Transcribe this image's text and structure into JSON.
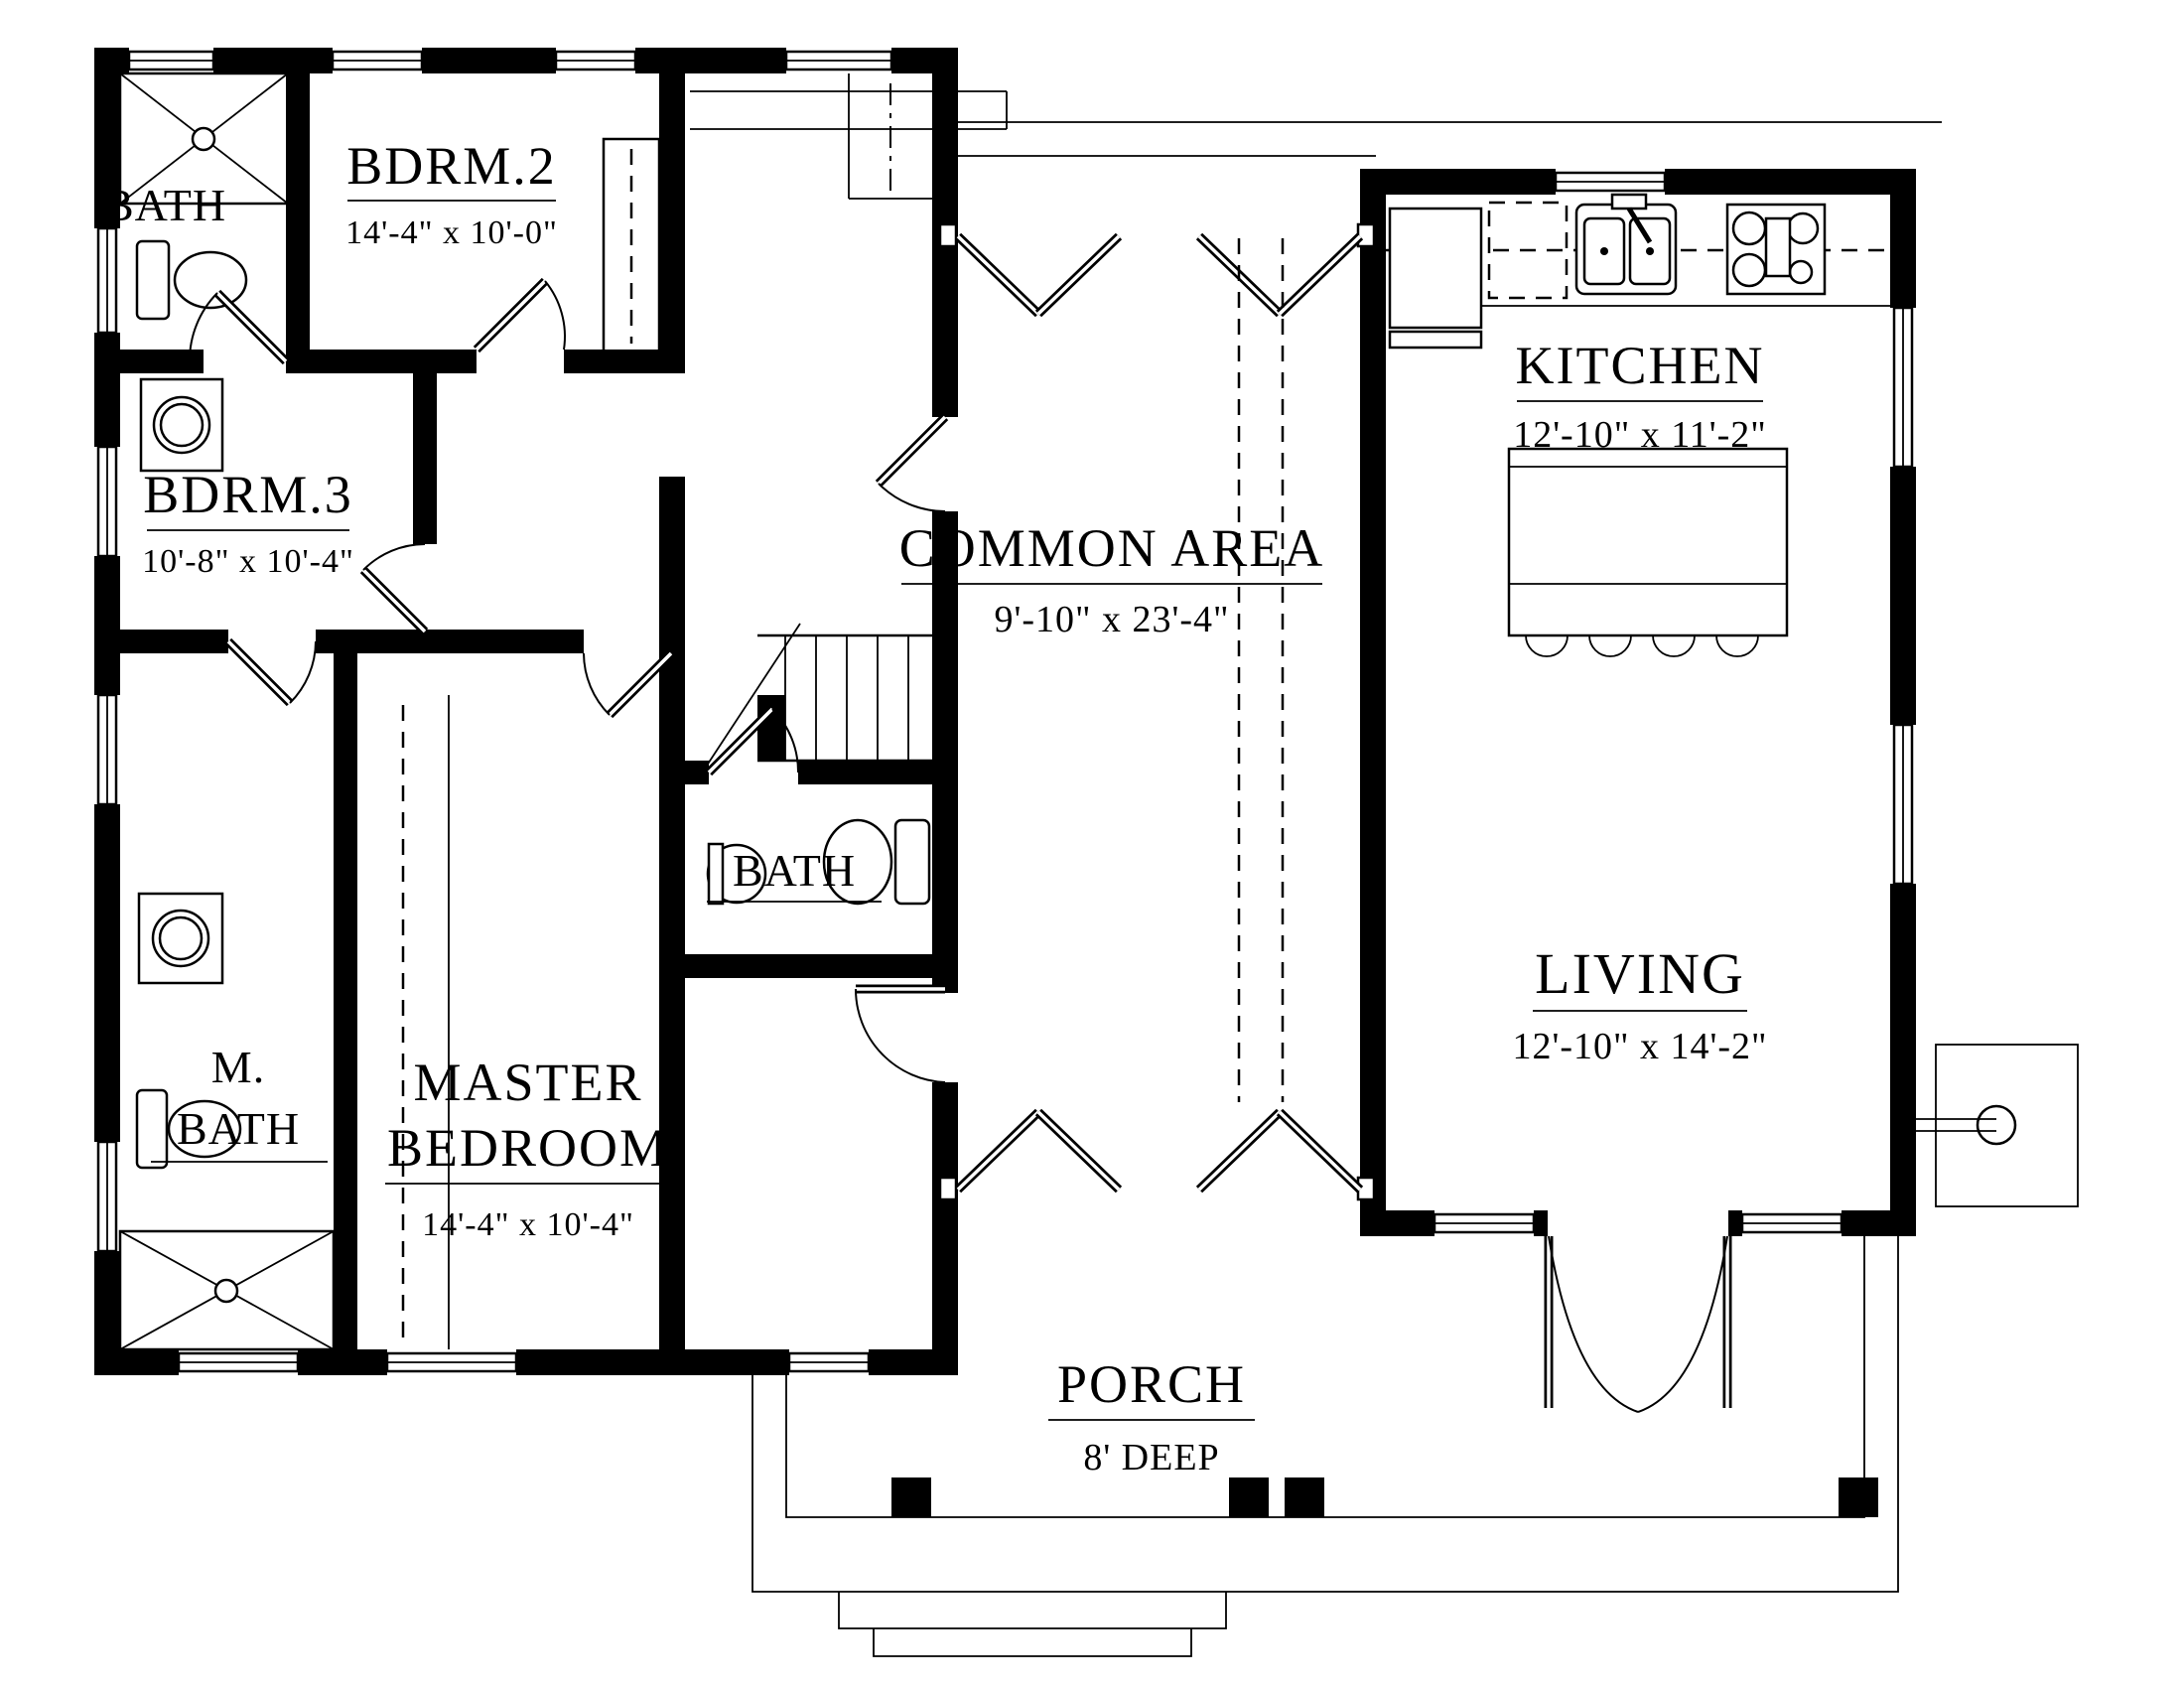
{
  "labels": {
    "bath_upper": {
      "name": "BATH"
    },
    "bdrm2": {
      "name": "BDRM.2",
      "dims": "14'-4\" x 10'-0\""
    },
    "bdrm3": {
      "name": "BDRM.3",
      "dims": "10'-8\" x 10'-4\""
    },
    "bath_mid": {
      "name": "BATH"
    },
    "mbath": {
      "line1": "M.",
      "line2": "BATH"
    },
    "master": {
      "line1": "MASTER",
      "line2": "BEDROOM",
      "dims": "14'-4\" x 10'-4\""
    },
    "kitchen": {
      "name": "KITCHEN",
      "dims": "12'-10\" x 11'-2\""
    },
    "common": {
      "name": "COMMON AREA",
      "dims": "9'-10\" x 23'-4\""
    },
    "living": {
      "name": "LIVING",
      "dims": "12'-10\" x 14'-2\""
    },
    "porch": {
      "name": "PORCH",
      "dims": "8' DEEP"
    }
  },
  "colors": {
    "ink": "#000000",
    "paper": "#ffffff"
  }
}
